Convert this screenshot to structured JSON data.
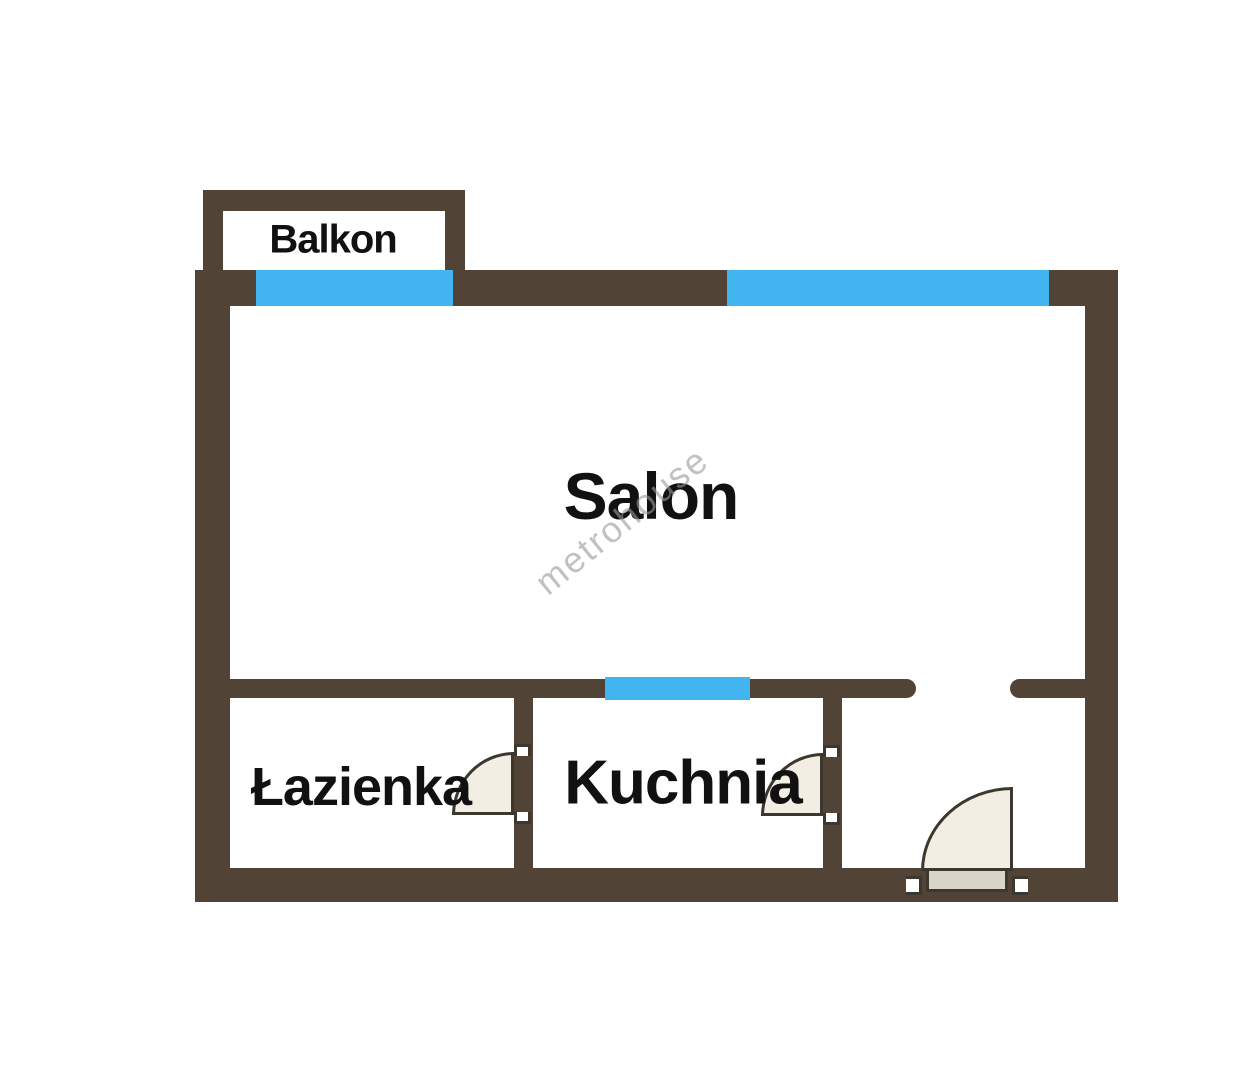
{
  "title": "Apartment floor plan",
  "rooms": {
    "balcony": {
      "label": "Balkon"
    },
    "living_room": {
      "label": "Salon"
    },
    "bathroom": {
      "label": "Łazienka"
    },
    "kitchen": {
      "label": "Kuchnia"
    }
  },
  "watermark": {
    "text": "metrohouse"
  },
  "colors": {
    "background": "#ffffff",
    "wall": "#514336",
    "window": "#42b4ef",
    "door_fill": "#f2eee3",
    "door_leaf": "#d9d4c7",
    "door_outline": "#3d382f",
    "label_text": "#111111",
    "watermark": "#999999"
  }
}
